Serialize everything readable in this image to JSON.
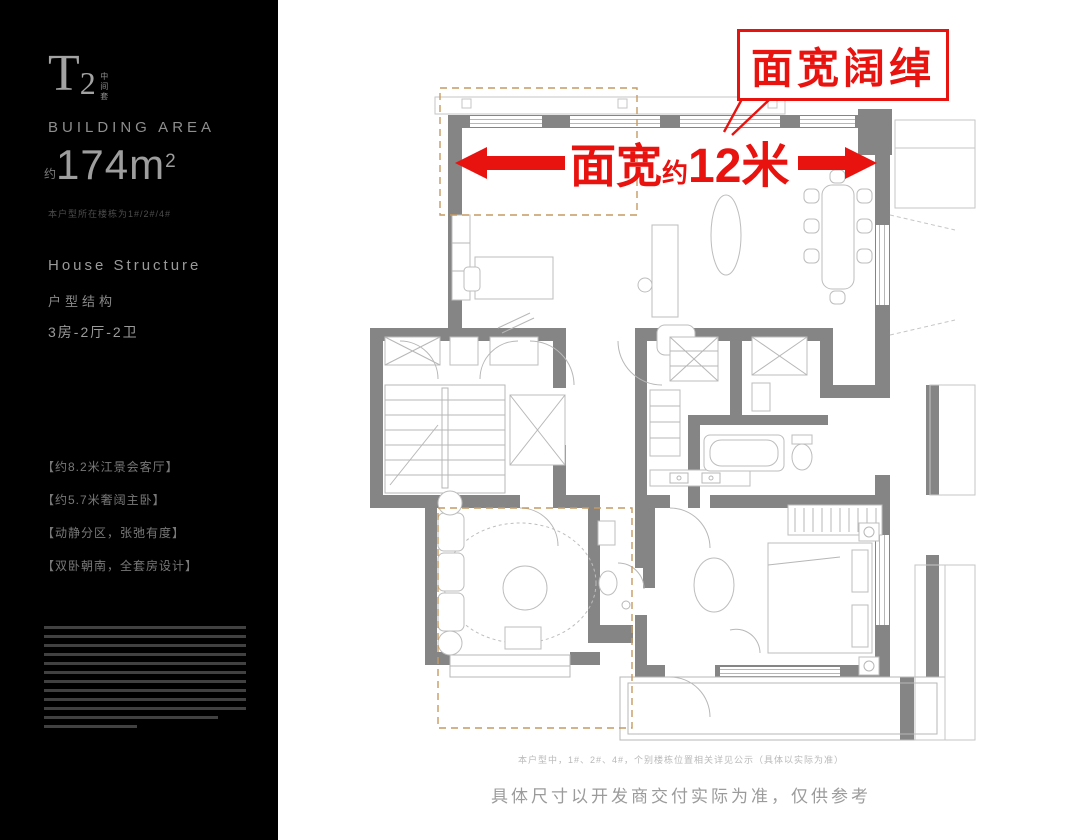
{
  "sidebar": {
    "unit_code_letter": "T",
    "unit_code_number": "2",
    "unit_tag": "中间套",
    "area_label": "BUILDING AREA",
    "area_prefix": "约",
    "area_value": "174m",
    "area_sup": "2",
    "building_note": "本户型所在楼栋为1#/2#/4#",
    "structure_label_en": "House Structure",
    "structure_label_cn": "户型结构",
    "structure_value": "3房-2厅-2卫",
    "features": [
      "【约8.2米江景会客厅】",
      "【约5.7米奢阔主卧】",
      "【动静分区，张弛有度】",
      "【双卧朝南，全套房设计】"
    ],
    "fine_print_line_widths": [
      100,
      100,
      100,
      100,
      100,
      100,
      100,
      100,
      100,
      100,
      86,
      46
    ]
  },
  "annotations": {
    "callout_label": "面宽阔绰",
    "dimension_prefix": "面宽",
    "dimension_about": "约",
    "dimension_value": "12米",
    "accent_color": "#e8120f",
    "highlight_dash_color": "#c79a62"
  },
  "floorplan": {
    "wall_color": "#858585",
    "line_color": "#b7b7b7",
    "elements": [
      "study-desk",
      "living-sofa",
      "dining-table",
      "kitchen-cabinets",
      "elevator-shaft",
      "stairs",
      "bathtub",
      "wardrobe",
      "master-bed",
      "second-bedroom-rug",
      "balcony"
    ]
  },
  "footer": {
    "note_small": "本户型中，1#、2#、4#，个别楼栋位置相关详见公示（具体以实际为准）",
    "note_main": "具体尺寸以开发商交付实际为准，仅供参考"
  }
}
